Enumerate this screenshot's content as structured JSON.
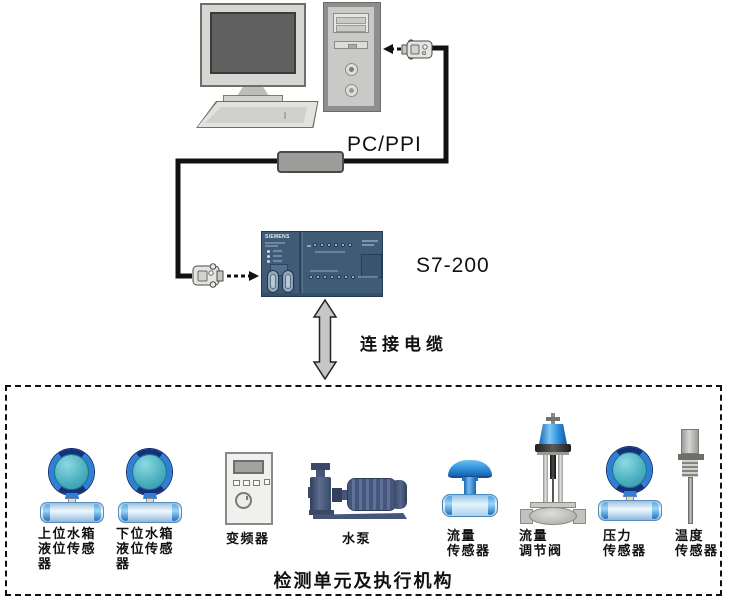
{
  "diagram": {
    "pc_ppi_label": "PC/PPI",
    "plc_label": "S7-200",
    "plc_brand": "SIEMENS",
    "cable_label": "连接电缆",
    "unit_box_title": "检测单元及执行机构"
  },
  "devices": [
    {
      "name": "upper-tank-level-sensor",
      "lines": [
        "上位水箱",
        "液位传感",
        "器"
      ]
    },
    {
      "name": "lower-tank-level-sensor",
      "lines": [
        "下位水箱",
        "液位传感",
        "器"
      ]
    },
    {
      "name": "inverter",
      "lines": [
        "变频器"
      ]
    },
    {
      "name": "water-pump",
      "lines": [
        "水泵"
      ]
    },
    {
      "name": "flow-sensor",
      "lines": [
        "流量",
        "传感器"
      ]
    },
    {
      "name": "flow-regulating-valve",
      "lines": [
        "流量",
        "调节阀"
      ]
    },
    {
      "name": "pressure-sensor",
      "lines": [
        "压力",
        "传感器"
      ]
    },
    {
      "name": "temperature-sensor",
      "lines": [
        "温度",
        "传感器"
      ]
    }
  ],
  "colors": {
    "plc_body": "#3f5b76",
    "sensor_blue": "#2f7fd6",
    "sensor_navy": "#14307c",
    "sensor_teal": "#49b0bf",
    "pump_slate": "#46567a",
    "cable_black": "#111111",
    "arrow_gray": "#c6c6c4"
  }
}
